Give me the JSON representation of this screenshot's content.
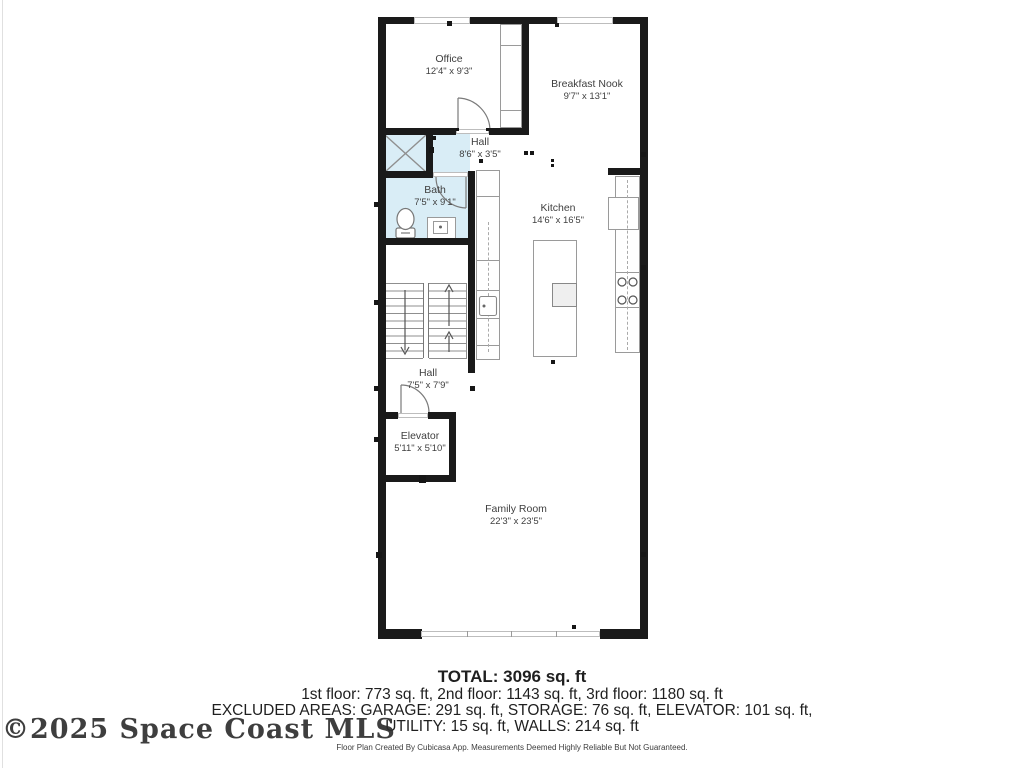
{
  "colors": {
    "wall": "#1a1a1a",
    "interior_line": "#9a9a9a",
    "bath_fill": "#d9edf6",
    "label": "#3f3f3f",
    "summary_text": "#1f1f1f",
    "watermark": "#2e2e2e"
  },
  "watermark": "©2025 Space Coast MLS",
  "rooms": [
    {
      "name": "Office",
      "dims": "12'4\" x 9'3\""
    },
    {
      "name": "Breakfast Nook",
      "dims": "9'7\" x 13'1\""
    },
    {
      "name": "Hall",
      "dims": "8'6\" x 3'5\""
    },
    {
      "name": "Bath",
      "dims": "7'5\" x 9'1\""
    },
    {
      "name": "Kitchen",
      "dims": "14'6\" x 16'5\""
    },
    {
      "name": "Hall",
      "dims": "7'5\" x 7'9\""
    },
    {
      "name": "Elevator",
      "dims": "5'11\" x 5'10\""
    },
    {
      "name": "Family Room",
      "dims": "22'3\" x 23'5\""
    }
  ],
  "summary": {
    "total": "TOTAL: 3096 sq. ft",
    "floors": "1st floor: 773 sq. ft, 2nd floor: 1143 sq. ft, 3rd floor: 1180 sq. ft",
    "excluded_1": "EXCLUDED AREAS: GARAGE: 291 sq. ft, STORAGE: 76 sq. ft, ELEVATOR: 101 sq. ft,",
    "excluded_2": "UTILITY: 15 sq. ft, WALLS: 214 sq. ft",
    "disclaimer": "Floor Plan Created By Cubicasa App. Measurements Deemed Highly Reliable But Not Guaranteed."
  }
}
